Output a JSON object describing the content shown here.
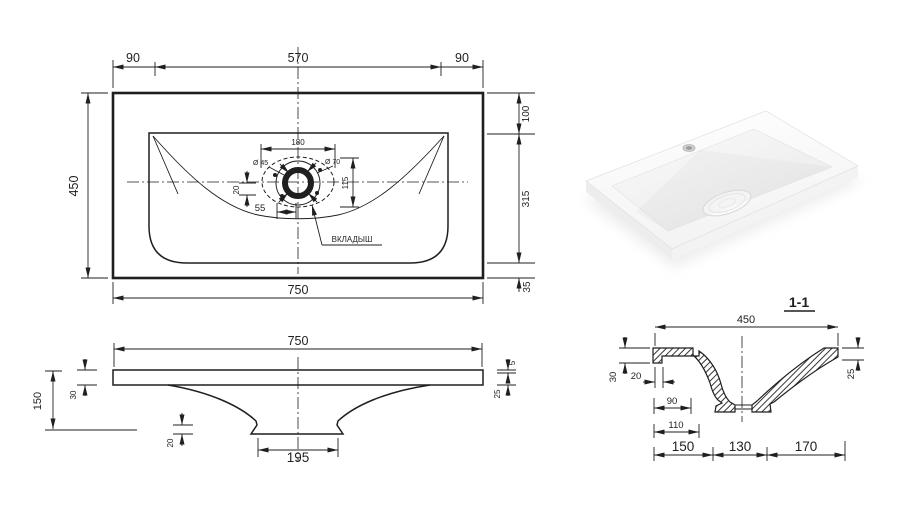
{
  "plan": {
    "dim_top_left": "90",
    "dim_top_center": "570",
    "dim_top_right": "90",
    "dim_left": "450",
    "dim_right_top": "100",
    "dim_right_middle": "315",
    "dim_right_bottom": "35",
    "dim_bottom": "750",
    "dim_drain_width": "180",
    "dim_drain_height": "115",
    "dia_drain_hole": "Ø 45",
    "dia_insert": "Ø 70",
    "dim_offset_down": "20",
    "dim_offset_right": "55",
    "insert_label": "ВКЛАДЫШ"
  },
  "front": {
    "dim_width": "750",
    "dim_height": "150",
    "dim_rim": "30",
    "dim_foot_height": "20",
    "dim_foot_width": "195",
    "dim_lip": "5",
    "dim_edge": "25"
  },
  "section": {
    "title": "1-1",
    "dim_width": "450",
    "dim_rim_left": "30",
    "dim_wall": "20",
    "dim_90": "90",
    "dim_110": "110",
    "dim_bottom_left": "150",
    "dim_bottom_center": "130",
    "dim_bottom_right": "170",
    "dim_rim_right": "25"
  },
  "colors": {
    "line": "#1f1f1f",
    "background": "#ffffff",
    "photo_shadow": "#e3e3e3"
  }
}
